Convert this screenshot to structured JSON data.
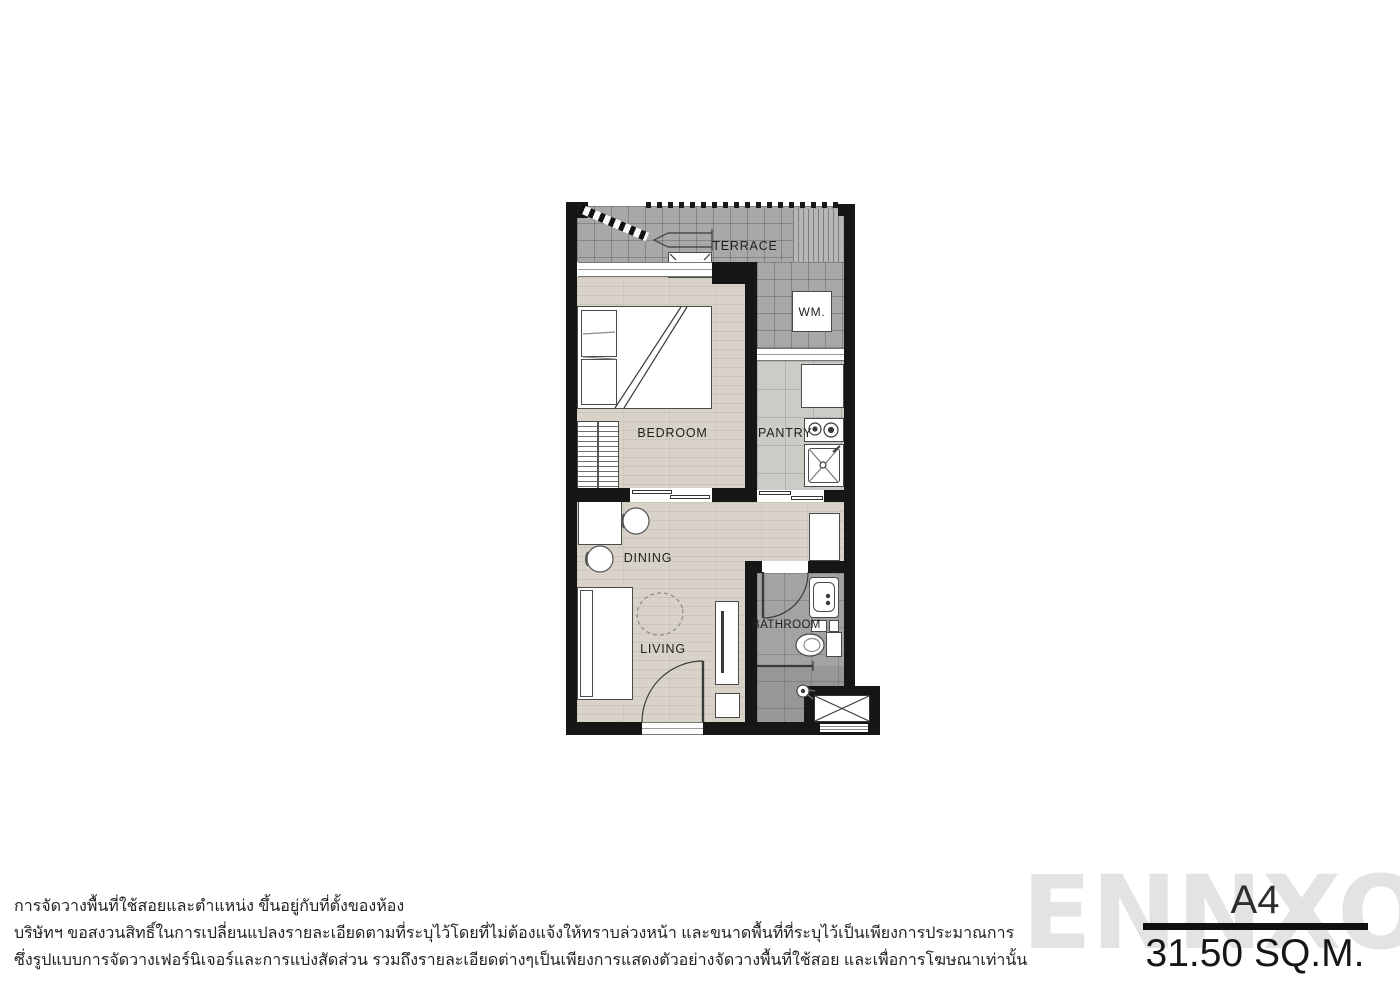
{
  "unit": {
    "code": "A4",
    "area": "31.50 SQ.M."
  },
  "watermark": {
    "text": "ENNXO"
  },
  "rooms": {
    "terrace": {
      "label": "TERRACE"
    },
    "bedroom": {
      "label": "BEDROOM"
    },
    "pantry": {
      "label": "PANTRY"
    },
    "dining": {
      "label": "DINING"
    },
    "living": {
      "label": "LIVING"
    },
    "bathroom": {
      "label": "BATHROOM"
    },
    "washer": {
      "label": "WM."
    }
  },
  "disclaimer": {
    "lines": [
      "การจัดวางพื้นที่ใช้สอยและตำแหน่ง ขึ้นอยู่กับที่ตั้งของห้อง",
      "บริษัทฯ ขอสงวนสิทธิ์ในการเปลี่ยนแปลงรายละเอียดตามที่ระบุไว้โดยที่ไม่ต้องแจ้งให้ทราบล่วงหน้า และขนาดพื้นที่ที่ระบุไว้เป็นเพียงการประมาณการ",
      "ซึ่งรูปแบบการจัดวางเฟอร์นิเจอร์และการแบ่งสัดส่วน รวมถึงรายละเอียดต่างๆเป็นเพียงการแสดงตัวอย่างจัดวางพื้นที่ใช้สอย และเพื่อการโฆษณาเท่านั้น"
    ]
  },
  "colors": {
    "wall": "#161616",
    "wood_floor": "#d8d2c8",
    "terrace_floor": "#a8a8a6",
    "pantry_floor": "#cacdc5",
    "bathroom_floor": "#a3a3a1",
    "watermark": "#e3e3e3",
    "title_bar": "#101010"
  }
}
